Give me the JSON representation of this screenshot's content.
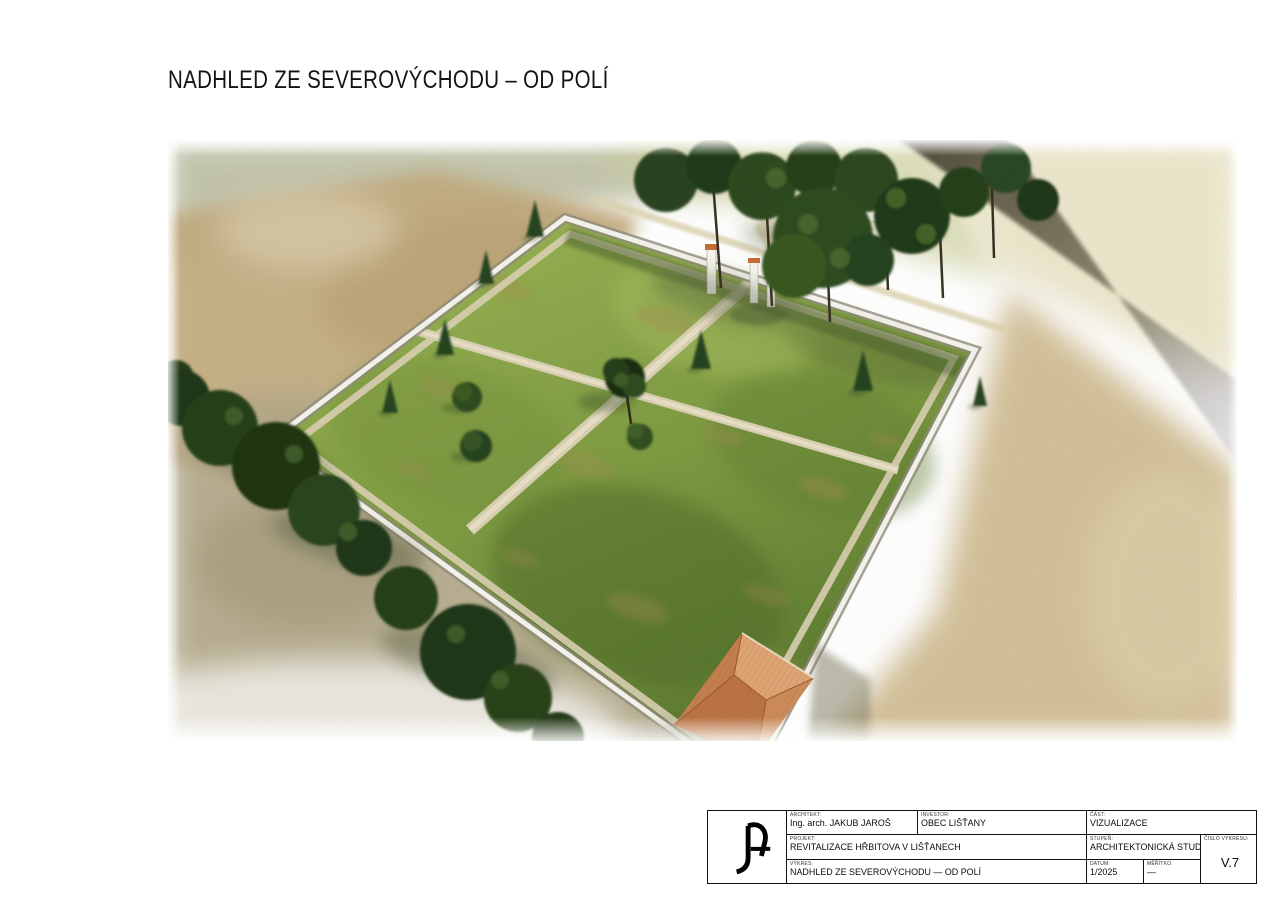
{
  "page": {
    "title": "NADHLED ZE SEVEROVÝCHODU – OD POLÍ"
  },
  "visualization": {
    "description": "aerial watercolor rendering of a walled cemetery seen from the northeast, cross-shaped gravel paths, lawn quadrants, perimeter wall, entrance gate with orange-capped piers, hip-roofed mortuary building, tree rows and fields around",
    "palette": {
      "lawn_green": "#7d9a40",
      "lawn_dark": "#4d6a27",
      "wall_white": "#f4f3ed",
      "path_gravel": "#d9cfb2",
      "roof_terracotta": "#cd8a58",
      "field_tan": "#c2ac80",
      "road_dark": "#4a4634",
      "tree_dark": "#26411b",
      "gate_cap_orange": "#c96a33"
    }
  },
  "titleblock": {
    "logo": "JA-monogram",
    "architect": {
      "label": "ARCHITEKT:",
      "value": "Ing. arch. JAKUB JAROŠ"
    },
    "investor": {
      "label": "INVESTOR:",
      "value": "OBEC LIŠŤANY"
    },
    "part": {
      "label": "ČÁST:",
      "value": "VIZUALIZACE"
    },
    "project": {
      "label": "PROJEKT:",
      "value": "REVITALIZACE HŘBITOVA V LIŠŤANECH"
    },
    "stage": {
      "label": "STUPEŇ:",
      "value": "ARCHITEKTONICKÁ STUDIE"
    },
    "drawing_no": {
      "label": "ČÍSLO VÝKRESU:",
      "value": "V.7"
    },
    "drawing": {
      "label": "VÝKRES:",
      "value": "NADHLED ZE SEVEROVÝCHODU — OD POLÍ"
    },
    "date": {
      "label": "DATUM:",
      "value": "1/2025"
    },
    "scale": {
      "label": "MĚŘÍTKO:",
      "value": "—"
    }
  }
}
